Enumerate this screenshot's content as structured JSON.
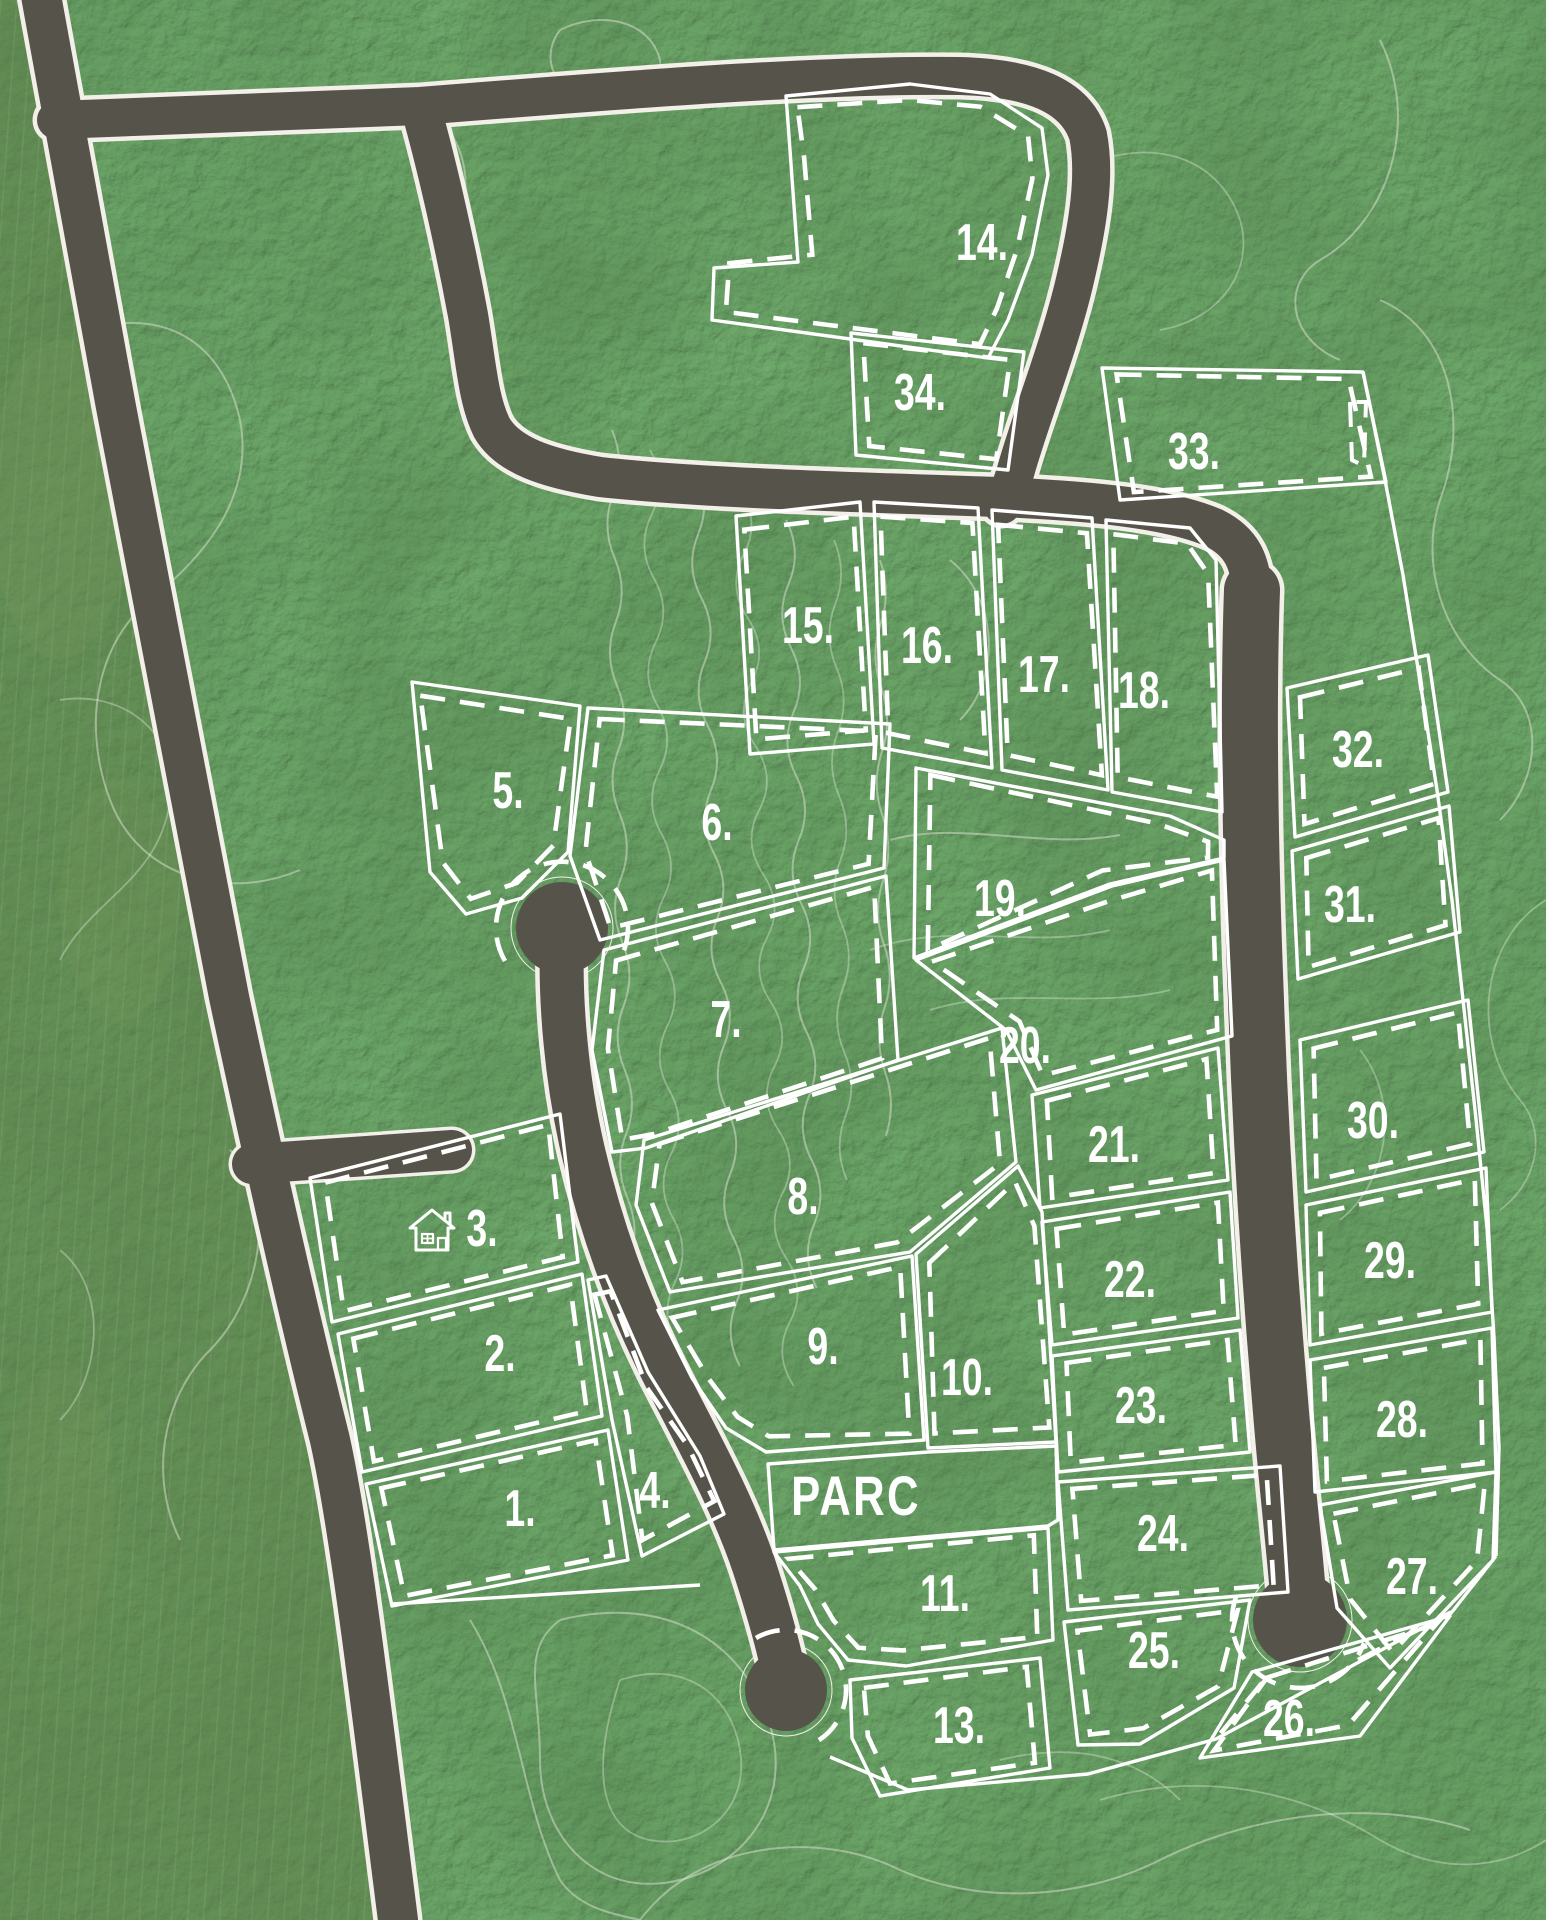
{
  "map": {
    "kind": "aerial-subdivision-plat",
    "park": {
      "label": "PARC",
      "x": 856,
      "y": 1496
    },
    "house_marker": {
      "at_lot": "3.",
      "x": 437,
      "y": 1232
    },
    "colors": {
      "forest": "#2e5429",
      "field": "#5f8049",
      "road": "#56544a",
      "road_casing": "#f2f0e9",
      "lot_line": "#ffffff",
      "contour": "#dde4d4"
    },
    "lots": [
      {
        "n": "1.",
        "x": 520,
        "y": 1508
      },
      {
        "n": "2.",
        "x": 500,
        "y": 1353
      },
      {
        "n": "3.",
        "x": 482,
        "y": 1228
      },
      {
        "n": "4.",
        "x": 655,
        "y": 1490
      },
      {
        "n": "5.",
        "x": 508,
        "y": 790
      },
      {
        "n": "6.",
        "x": 717,
        "y": 822
      },
      {
        "n": "7.",
        "x": 726,
        "y": 1019
      },
      {
        "n": "8.",
        "x": 803,
        "y": 1196
      },
      {
        "n": "9.",
        "x": 823,
        "y": 1346
      },
      {
        "n": "10.",
        "x": 967,
        "y": 1377
      },
      {
        "n": "11.",
        "x": 945,
        "y": 1593
      },
      {
        "n": "13.",
        "x": 959,
        "y": 1725
      },
      {
        "n": "14.",
        "x": 982,
        "y": 242
      },
      {
        "n": "15.",
        "x": 808,
        "y": 625
      },
      {
        "n": "16.",
        "x": 927,
        "y": 645
      },
      {
        "n": "17.",
        "x": 1044,
        "y": 674
      },
      {
        "n": "18.",
        "x": 1144,
        "y": 690
      },
      {
        "n": "19.",
        "x": 1000,
        "y": 898
      },
      {
        "n": "20.",
        "x": 1025,
        "y": 1045
      },
      {
        "n": "21.",
        "x": 1114,
        "y": 1144
      },
      {
        "n": "22.",
        "x": 1130,
        "y": 1279
      },
      {
        "n": "23.",
        "x": 1141,
        "y": 1405
      },
      {
        "n": "24.",
        "x": 1163,
        "y": 1533
      },
      {
        "n": "25.",
        "x": 1154,
        "y": 1650
      },
      {
        "n": "26.",
        "x": 1289,
        "y": 1718
      },
      {
        "n": "27.",
        "x": 1412,
        "y": 1576
      },
      {
        "n": "28.",
        "x": 1402,
        "y": 1419
      },
      {
        "n": "29.",
        "x": 1390,
        "y": 1260
      },
      {
        "n": "30.",
        "x": 1373,
        "y": 1120
      },
      {
        "n": "31.",
        "x": 1350,
        "y": 904
      },
      {
        "n": "32.",
        "x": 1358,
        "y": 749
      },
      {
        "n": "33.",
        "x": 1194,
        "y": 451
      },
      {
        "n": "34.",
        "x": 920,
        "y": 392
      }
    ]
  }
}
